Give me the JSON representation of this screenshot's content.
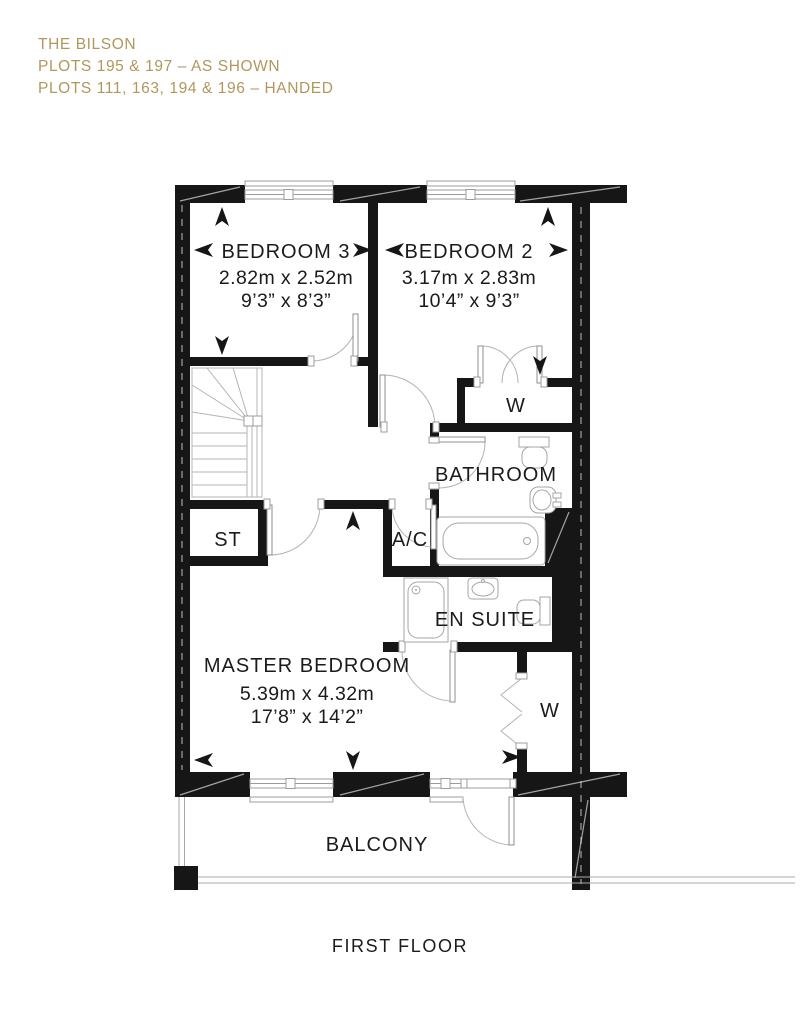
{
  "header": {
    "title": "THE BILSON",
    "plots_shown": "PLOTS 195 & 197 – AS SHOWN",
    "plots_handed": "PLOTS 111, 163, 194 & 196 – HANDED"
  },
  "rooms": {
    "bedroom3": {
      "name": "BEDROOM 3",
      "metric": "2.82m x 2.52m",
      "imperial": "9’3” x 8’3”"
    },
    "bedroom2": {
      "name": "BEDROOM 2",
      "metric": "3.17m x 2.83m",
      "imperial": "10’4” x 9’3”"
    },
    "master": {
      "name": "MASTER BEDROOM",
      "metric": "5.39m x 4.32m",
      "imperial": "17’8” x 14’2”"
    },
    "bathroom": {
      "name": "BATHROOM"
    },
    "ensuite": {
      "name": "EN SUITE"
    },
    "store": {
      "name": "ST"
    },
    "airing_cupboard": {
      "name": "A/C"
    },
    "wardrobe_bedroom2": {
      "name": "W"
    },
    "wardrobe_master": {
      "name": "W"
    },
    "balcony": {
      "name": "BALCONY"
    }
  },
  "footer": {
    "caption": "FIRST FLOOR"
  },
  "colors": {
    "accent": "#b2975c",
    "wall": "#161616",
    "line": "#9c9c9c"
  }
}
